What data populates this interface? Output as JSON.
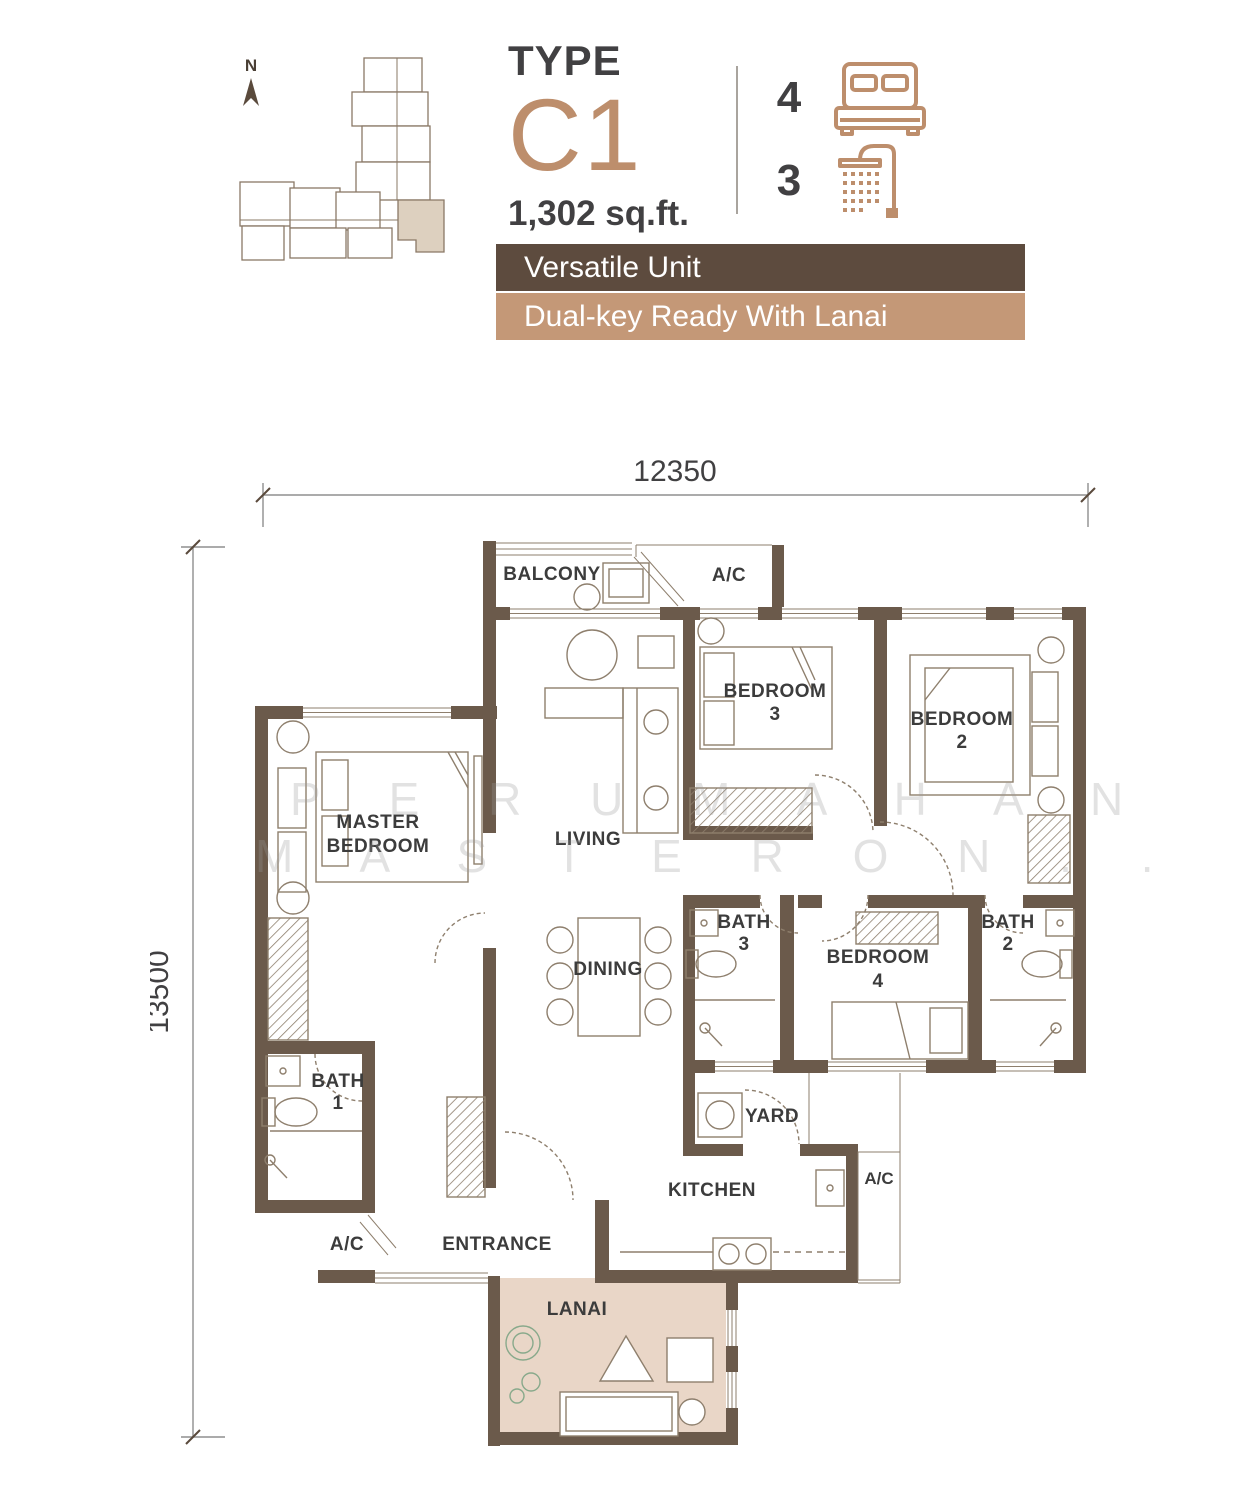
{
  "header": {
    "north_label": "N",
    "type_label": "TYPE",
    "unit_code": "C1",
    "area": "1,302 sq.ft.",
    "bedroom_count": "4",
    "bathroom_count": "3",
    "banner_primary": "Versatile Unit",
    "banner_secondary": "Dual-key Ready With Lanai"
  },
  "dimensions": {
    "width": "12350",
    "height": "13500"
  },
  "rooms": {
    "balcony": "BALCONY",
    "ac": "A/C",
    "living": "LIVING",
    "dining": "DINING",
    "master_line1": "MASTER",
    "bedroom": "BEDROOM",
    "bath": "BATH",
    "num1": "1",
    "num2": "2",
    "num3": "3",
    "num4": "4",
    "yard": "YARD",
    "kitchen": "KITCHEN",
    "entrance": "ENTRANCE",
    "lanai": "LANAI"
  },
  "watermark": {
    "line1": "P E R U M A H A N",
    "line2": "M A S T E R O N . . ."
  },
  "colors": {
    "wall": "#6b5a4b",
    "accent": "#bd8e6c",
    "banner_dark": "#5d4b3e",
    "banner_tan": "#c49877",
    "lanai_floor": "#e9d6c7",
    "keyplan_highlight": "#ddd0bf"
  }
}
